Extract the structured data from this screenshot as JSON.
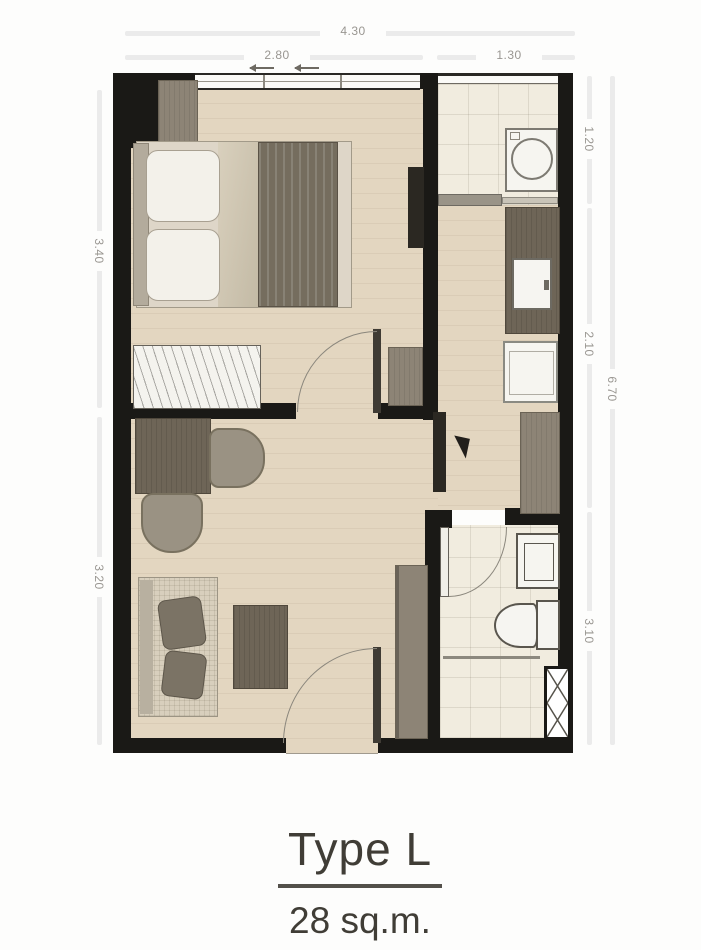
{
  "title": {
    "type_label": "Type L",
    "area_label": "28 sq.m."
  },
  "dimensions": {
    "top_total": "4.30",
    "top_bedroom": "2.80",
    "top_balcony": "1.30",
    "left_bedroom": "3.40",
    "left_living": "3.20",
    "right_balcony": "1.20",
    "right_kitchen": "2.10",
    "right_bathroom": "3.10",
    "right_total": "6.70"
  },
  "colors": {
    "wall": "#1a1916",
    "wood_floor": "#e3d6c0",
    "tile_floor": "#f1ecdf",
    "furniture_wood": "#8d8476",
    "counter_wood": "#6e6557",
    "dimension_text": "#999691",
    "title_text": "#403d36"
  }
}
